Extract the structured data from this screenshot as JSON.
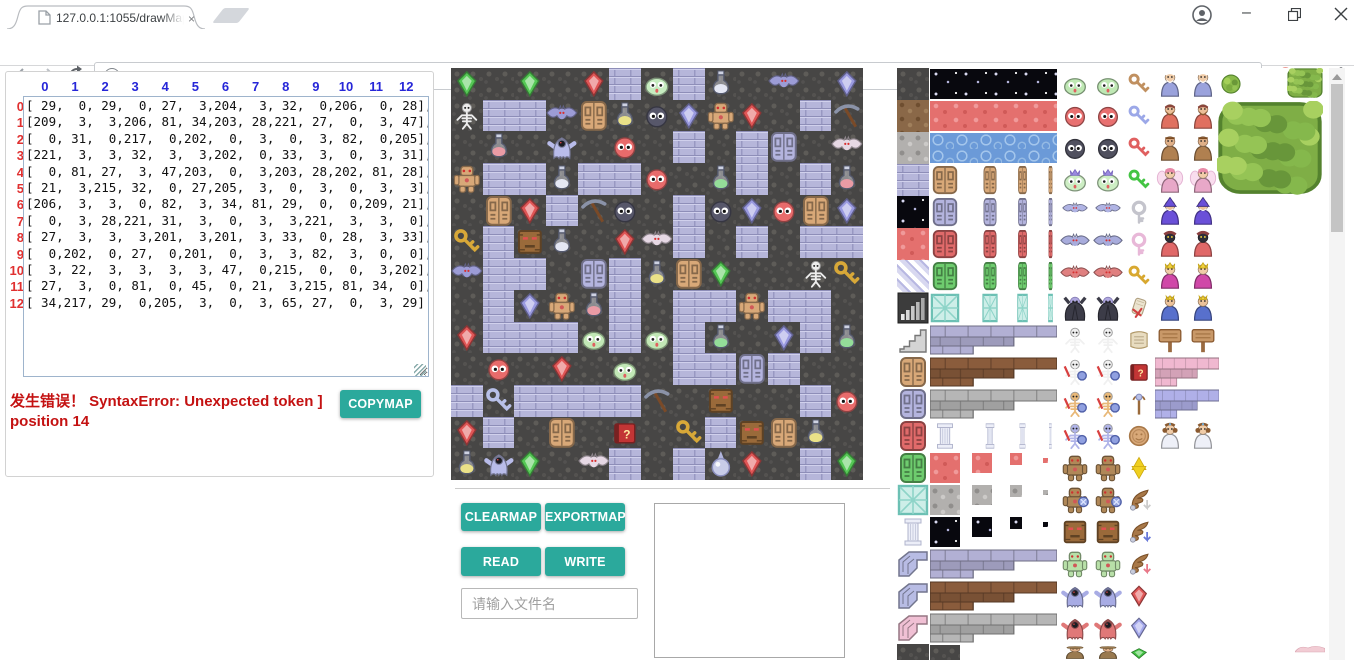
{
  "browser": {
    "tab": {
      "title": "127.0.0.1:1055/drawMapGUI.html",
      "close_glyph": "×"
    },
    "url": {
      "host": "127.0.0.1:1055",
      "path": "/drawMapGUI.html"
    },
    "icons": [
      "page-icon",
      "new-tab-button",
      "profile-icon",
      "minimize-icon",
      "restore-icon",
      "close-icon",
      "back-icon",
      "forward-icon",
      "reload-icon",
      "info-icon",
      "star-icon",
      "adblock-hand-icon",
      "checkbox-extension-icon",
      "kebab-menu-icon"
    ]
  },
  "editor": {
    "col_headers": [
      "0",
      "1",
      "2",
      "3",
      "4",
      "5",
      "6",
      "7",
      "8",
      "9",
      "10",
      "11",
      "12"
    ],
    "row_headers": [
      "0",
      "1",
      "2",
      "3",
      "4",
      "5",
      "6",
      "7",
      "8",
      "9",
      "10",
      "11",
      "12"
    ],
    "error_text": "发生错误！ SyntaxError: Unexpected token ] position 14",
    "copymap_label": "COPYMAP"
  },
  "controls": {
    "clearmap": "CLEARMAP",
    "exportmap": "EXPORTMAP",
    "read": "READ",
    "write": "WRITE",
    "filename_placeholder": "请输入文件名"
  },
  "map": {
    "grid": [
      [
        29,
        0,
        29,
        0,
        27,
        3,
        204,
        3,
        32,
        0,
        206,
        0,
        28
      ],
      [
        209,
        3,
        3,
        206,
        81,
        34,
        203,
        28,
        221,
        27,
        0,
        3,
        47
      ],
      [
        0,
        31,
        0,
        217,
        0,
        202,
        0,
        3,
        0,
        3,
        82,
        0,
        205
      ],
      [
        221,
        3,
        3,
        32,
        3,
        3,
        202,
        0,
        33,
        3,
        0,
        3,
        31
      ],
      [
        0,
        81,
        27,
        3,
        47,
        203,
        0,
        3,
        203,
        28,
        202,
        81,
        28
      ],
      [
        21,
        3,
        215,
        32,
        0,
        27,
        205,
        3,
        0,
        3,
        0,
        3,
        3
      ],
      [
        206,
        3,
        3,
        0,
        82,
        3,
        34,
        81,
        29,
        0,
        0,
        209,
        21
      ],
      [
        0,
        3,
        28,
        221,
        31,
        3,
        0,
        3,
        3,
        221,
        3,
        3,
        0
      ],
      [
        27,
        3,
        3,
        3,
        201,
        3,
        201,
        3,
        33,
        0,
        28,
        3,
        33
      ],
      [
        0,
        202,
        0,
        27,
        0,
        201,
        0,
        3,
        3,
        82,
        3,
        0,
        0
      ],
      [
        3,
        22,
        3,
        3,
        3,
        3,
        47,
        0,
        215,
        0,
        0,
        3,
        202
      ],
      [
        27,
        3,
        0,
        81,
        0,
        45,
        0,
        21,
        3,
        215,
        81,
        34,
        0
      ],
      [
        34,
        217,
        29,
        0,
        205,
        3,
        0,
        3,
        65,
        27,
        0,
        3,
        29
      ]
    ],
    "legend": {
      "0": {
        "name": "dark-ground",
        "kind": "tex",
        "color": "dark"
      },
      "3": {
        "name": "brick-wall",
        "kind": "tex",
        "color": "brick"
      },
      "21": {
        "name": "gold-key",
        "kind": "key",
        "color": "#d8a838"
      },
      "22": {
        "name": "silver-key",
        "kind": "key",
        "color": "#b8c0e8"
      },
      "27": {
        "name": "red-gem",
        "kind": "gem",
        "color": "#e05555"
      },
      "28": {
        "name": "purple-gem",
        "kind": "gem",
        "color": "#9a9ae0"
      },
      "29": {
        "name": "green-gem",
        "kind": "gem",
        "color": "#55c855"
      },
      "31": {
        "name": "red-potion",
        "kind": "potion",
        "color": "#e8606a"
      },
      "32": {
        "name": "silver-potion",
        "kind": "potion",
        "color": "#dfe2f2"
      },
      "33": {
        "name": "green-potion",
        "kind": "potion",
        "color": "#55d055"
      },
      "34": {
        "name": "yellow-potion",
        "kind": "potion",
        "color": "#e8d838"
      },
      "45": {
        "name": "question-book",
        "kind": "book",
        "color": "#c23535"
      },
      "47": {
        "name": "pickaxe",
        "kind": "pickaxe",
        "color": "#8a92a8"
      },
      "65": {
        "name": "magic-orb",
        "kind": "orb",
        "color": "#c8cce8"
      },
      "81": {
        "name": "wooden-door",
        "kind": "door",
        "color": "#d8a878"
      },
      "82": {
        "name": "silver-door",
        "kind": "door",
        "color": "#b4b4de"
      },
      "201": {
        "name": "green-slime",
        "kind": "slime",
        "color": "#c2e8b6"
      },
      "202": {
        "name": "red-blob",
        "kind": "blob",
        "color": "#e86b6b"
      },
      "203": {
        "name": "dark-blob",
        "kind": "blob",
        "color": "#57576a"
      },
      "204": {
        "name": "big-green-slime",
        "kind": "slime",
        "color": "#c6ecc0"
      },
      "205": {
        "name": "pink-bat",
        "kind": "bat",
        "color": "#e6d8e4"
      },
      "206": {
        "name": "purple-bat",
        "kind": "bat",
        "color": "#9c9cd6"
      },
      "209": {
        "name": "skeleton",
        "kind": "skeleton",
        "color": "#ededed"
      },
      "215": {
        "name": "stone-face",
        "kind": "face",
        "color": "#9a6a3a"
      },
      "217": {
        "name": "ghost",
        "kind": "ghost",
        "color": "#b9bcea"
      },
      "221": {
        "name": "golem",
        "kind": "golem",
        "color": "#d8a878"
      }
    }
  },
  "tileset": {
    "sprites": [
      [
        0,
        0,
        32,
        32,
        "tex",
        "dark"
      ],
      [
        0,
        32,
        32,
        32,
        "tex",
        "dirt"
      ],
      [
        0,
        64,
        32,
        32,
        "tex",
        "gstone"
      ],
      [
        0,
        96,
        32,
        32,
        "tex",
        "brick"
      ],
      [
        0,
        128,
        32,
        32,
        "tex",
        "starry"
      ],
      [
        0,
        160,
        32,
        32,
        "tex",
        "redcave"
      ],
      [
        0,
        192,
        32,
        32,
        "tex",
        "diag"
      ],
      [
        0,
        224,
        32,
        32,
        "bars",
        ""
      ],
      [
        0,
        256,
        32,
        32,
        "stairs",
        ""
      ],
      [
        0,
        288,
        32,
        32,
        "door",
        "#d8a878"
      ],
      [
        0,
        320,
        32,
        32,
        "door",
        "#b4b4de"
      ],
      [
        0,
        352,
        32,
        32,
        "door",
        "#e06a6a"
      ],
      [
        0,
        384,
        32,
        32,
        "door",
        "#6ecc6e"
      ],
      [
        0,
        416,
        32,
        32,
        "doorice",
        ""
      ],
      [
        0,
        448,
        32,
        32,
        "pillar",
        ""
      ],
      [
        0,
        480,
        32,
        32,
        "wingwall",
        "#b8bce4"
      ],
      [
        0,
        512,
        32,
        32,
        "wingwall",
        "#b8bce4"
      ],
      [
        0,
        544,
        32,
        32,
        "wingwall",
        "#f0c0d4"
      ],
      [
        0,
        576,
        32,
        16,
        "tex",
        "dark"
      ],
      [
        33,
        1,
        127,
        30,
        "tex",
        "starry"
      ],
      [
        33,
        33,
        127,
        30,
        "tex",
        "redcave"
      ],
      [
        33,
        65,
        127,
        30,
        "tex",
        "water"
      ],
      [
        33,
        97,
        30,
        30,
        "door",
        "#d8a878"
      ],
      [
        85,
        97,
        16,
        30,
        "door",
        "#d8a878"
      ],
      [
        120,
        97,
        11,
        30,
        "door",
        "#d8a878"
      ],
      [
        151,
        97,
        5,
        30,
        "door",
        "#d8a878"
      ],
      [
        33,
        129,
        30,
        30,
        "door",
        "#b4b4de"
      ],
      [
        85,
        129,
        16,
        30,
        "door",
        "#b4b4de"
      ],
      [
        120,
        129,
        11,
        30,
        "door",
        "#b4b4de"
      ],
      [
        151,
        129,
        5,
        30,
        "door",
        "#b4b4de"
      ],
      [
        33,
        161,
        30,
        30,
        "door",
        "#e06a6a"
      ],
      [
        85,
        161,
        16,
        30,
        "door",
        "#e06a6a"
      ],
      [
        120,
        161,
        11,
        30,
        "door",
        "#e06a6a"
      ],
      [
        151,
        161,
        5,
        30,
        "door",
        "#e06a6a"
      ],
      [
        33,
        193,
        30,
        30,
        "door",
        "#6ecc6e"
      ],
      [
        85,
        193,
        16,
        30,
        "door",
        "#6ecc6e"
      ],
      [
        120,
        193,
        11,
        30,
        "door",
        "#6ecc6e"
      ],
      [
        151,
        193,
        5,
        30,
        "door",
        "#6ecc6e"
      ],
      [
        33,
        225,
        30,
        30,
        "doorice",
        ""
      ],
      [
        85,
        225,
        16,
        30,
        "doorice",
        ""
      ],
      [
        120,
        225,
        11,
        30,
        "doorice",
        ""
      ],
      [
        151,
        225,
        5,
        30,
        "doorice",
        ""
      ],
      [
        33,
        257,
        127,
        30,
        "wall",
        "#b2b0d4"
      ],
      [
        33,
        289,
        127,
        30,
        "wall",
        "#8a5c3c"
      ],
      [
        33,
        321,
        127,
        30,
        "wall",
        "#b6b6b6"
      ],
      [
        33,
        353,
        30,
        30,
        "pillar",
        ""
      ],
      [
        85,
        353,
        16,
        30,
        "pillar",
        ""
      ],
      [
        120,
        353,
        11,
        30,
        "pillar",
        ""
      ],
      [
        151,
        353,
        5,
        30,
        "pillar",
        ""
      ],
      [
        33,
        385,
        30,
        30,
        "tex",
        "redcave"
      ],
      [
        75,
        385,
        20,
        20,
        "tex",
        "redcave"
      ],
      [
        113,
        385,
        12,
        12,
        "tex",
        "redcave"
      ],
      [
        146,
        390,
        5,
        5,
        "tex",
        "redcave"
      ],
      [
        33,
        417,
        30,
        30,
        "tex",
        "gstone"
      ],
      [
        75,
        417,
        20,
        20,
        "tex",
        "gstone"
      ],
      [
        113,
        417,
        12,
        12,
        "tex",
        "gstone"
      ],
      [
        146,
        422,
        5,
        5,
        "tex",
        "gstone"
      ],
      [
        33,
        449,
        30,
        30,
        "tex",
        "starry"
      ],
      [
        75,
        449,
        20,
        20,
        "tex",
        "starry"
      ],
      [
        113,
        449,
        12,
        12,
        "tex",
        "starry"
      ],
      [
        146,
        454,
        5,
        5,
        "tex",
        "starry"
      ],
      [
        33,
        481,
        127,
        30,
        "wall",
        "#b2b0d4"
      ],
      [
        33,
        513,
        127,
        30,
        "wall",
        "#8a5c3c"
      ],
      [
        33,
        545,
        127,
        30,
        "wall",
        "#b6b6b6"
      ],
      [
        33,
        577,
        30,
        15,
        "tex",
        "dark"
      ],
      [
        163,
        1,
        30,
        30,
        "slime",
        "#bfe8b4",
        1
      ],
      [
        163,
        33,
        30,
        30,
        "blob",
        "#e87070",
        1
      ],
      [
        163,
        65,
        30,
        30,
        "blob",
        "#50505f",
        1
      ],
      [
        163,
        97,
        30,
        30,
        "slimecrown",
        "#cdeec4",
        1
      ],
      [
        165,
        131,
        26,
        22,
        "bat",
        "#b0b4e4",
        1
      ],
      [
        163,
        161,
        30,
        28,
        "bat",
        "#a8acdc",
        1
      ],
      [
        163,
        193,
        30,
        28,
        "bat",
        "#e08080",
        1
      ],
      [
        163,
        225,
        30,
        30,
        "vampire",
        "#3c3c48",
        1
      ],
      [
        163,
        257,
        30,
        30,
        "skeleton",
        "#f0f0f0",
        1
      ],
      [
        163,
        289,
        30,
        30,
        "skelarm",
        "#f0f0f0",
        1
      ],
      [
        163,
        321,
        30,
        30,
        "skelarm",
        "#e8b878",
        1
      ],
      [
        163,
        353,
        30,
        30,
        "skelarm",
        "#b0b4e8",
        1
      ],
      [
        163,
        385,
        30,
        30,
        "golem",
        "#b08858",
        1
      ],
      [
        163,
        417,
        30,
        30,
        "golemarm",
        "#b08858",
        1
      ],
      [
        163,
        449,
        30,
        30,
        "face",
        "#9a6a3a",
        1
      ],
      [
        163,
        481,
        30,
        30,
        "golem",
        "#b8e0a8",
        1
      ],
      [
        163,
        513,
        30,
        30,
        "ghost",
        "#a8ace4",
        1
      ],
      [
        163,
        545,
        30,
        30,
        "ghost",
        "#e07878",
        1
      ],
      [
        163,
        577,
        30,
        15,
        "hatguy",
        "#9a7a50",
        1
      ],
      [
        229,
        3,
        26,
        26,
        "key",
        "#c09060"
      ],
      [
        229,
        35,
        26,
        26,
        "key",
        "#9ca8e8"
      ],
      [
        229,
        67,
        26,
        26,
        "key",
        "#e06060"
      ],
      [
        229,
        99,
        26,
        26,
        "key",
        "#44c444"
      ],
      [
        229,
        131,
        26,
        26,
        "keyring",
        "#c4c4cc"
      ],
      [
        229,
        163,
        26,
        26,
        "keyring",
        "#e8b8d8"
      ],
      [
        229,
        195,
        26,
        26,
        "key",
        "#d8a830"
      ],
      [
        229,
        227,
        26,
        26,
        "scroll",
        ""
      ],
      [
        229,
        259,
        26,
        26,
        "scrollopen",
        ""
      ],
      [
        229,
        291,
        26,
        26,
        "book",
        "#c23535"
      ],
      [
        229,
        323,
        26,
        26,
        "staff",
        ""
      ],
      [
        229,
        355,
        26,
        26,
        "coin",
        ""
      ],
      [
        229,
        387,
        26,
        26,
        "star",
        ""
      ],
      [
        229,
        419,
        26,
        26,
        "wing",
        ""
      ],
      [
        229,
        451,
        26,
        26,
        "wing",
        "#6878d8"
      ],
      [
        229,
        483,
        26,
        26,
        "wing",
        "#e87888"
      ],
      [
        229,
        515,
        26,
        26,
        "gem",
        "#e05858"
      ],
      [
        229,
        547,
        26,
        26,
        "gem",
        "#a4a8ec"
      ],
      [
        229,
        579,
        26,
        13,
        "gem",
        "#44c444"
      ],
      [
        258,
        1,
        30,
        30,
        "elder",
        "#9aa2dc",
        1
      ],
      [
        258,
        33,
        30,
        30,
        "dwarf",
        "#e07060",
        1
      ],
      [
        258,
        65,
        30,
        30,
        "fighter",
        "#c08850",
        1
      ],
      [
        258,
        97,
        30,
        30,
        "fairy",
        "#e8a8c8",
        1
      ],
      [
        258,
        129,
        30,
        30,
        "wizard",
        "#6a50d8",
        1
      ],
      [
        258,
        161,
        30,
        30,
        "priest",
        "#e06868",
        1
      ],
      [
        258,
        193,
        30,
        30,
        "queen",
        "#d048a8",
        1
      ],
      [
        258,
        225,
        30,
        30,
        "prince",
        "#5870cc",
        1
      ],
      [
        258,
        257,
        30,
        30,
        "sign",
        "",
        1
      ],
      [
        258,
        289,
        64,
        30,
        "wall",
        "#f0b8d0"
      ],
      [
        258,
        321,
        64,
        30,
        "wall",
        "#b0b0e8"
      ],
      [
        258,
        353,
        30,
        30,
        "princess",
        "#eef0f8",
        1
      ],
      [
        322,
        4,
        24,
        24,
        "tree",
        ""
      ],
      [
        390,
        0,
        36,
        30,
        "treebig",
        ""
      ],
      [
        320,
        33,
        106,
        94,
        "treebig",
        ""
      ],
      [
        398,
        576,
        30,
        16,
        "pinkblob",
        ""
      ]
    ]
  },
  "colors": {
    "accent": "#2ba99c",
    "error": "#c41212",
    "col_header": "#2626d8",
    "row_header": "#e03030"
  }
}
